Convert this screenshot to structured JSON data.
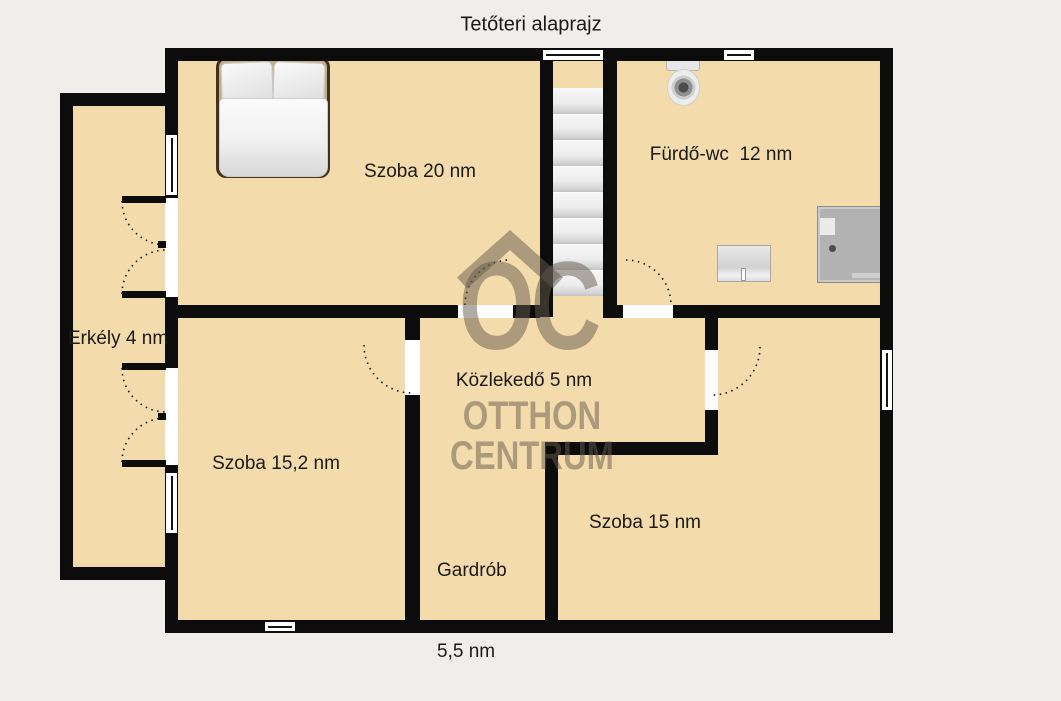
{
  "title": "Tetőteri alaprajz",
  "watermark": {
    "logo_text": "OC",
    "line1": "OTTHON",
    "line2": "CENTRUM"
  },
  "rooms": {
    "szoba20": "Szoba 20 nm",
    "furdo_wc": "Fürdő-wc  12 nm",
    "erkely": "Erkély 4 nm",
    "szoba152": "Szoba 15,2 nm",
    "kozlekedo": "Közlekedő 5 nm",
    "gardrob_name": "Gardrób",
    "gardrob_area": "5,5 nm",
    "szoba15": "Szoba 15 nm"
  },
  "furniture": {
    "bed": "double-bed",
    "toilet": "toilet",
    "sink": "washbasin",
    "shower": "shower-cabin",
    "stairs": "staircase"
  },
  "colors": {
    "background": "#f0eeea",
    "floor": "#f3dbab",
    "wall": "#0c0c0c",
    "stairs": "#ececec",
    "watermark": "#635a4c"
  }
}
